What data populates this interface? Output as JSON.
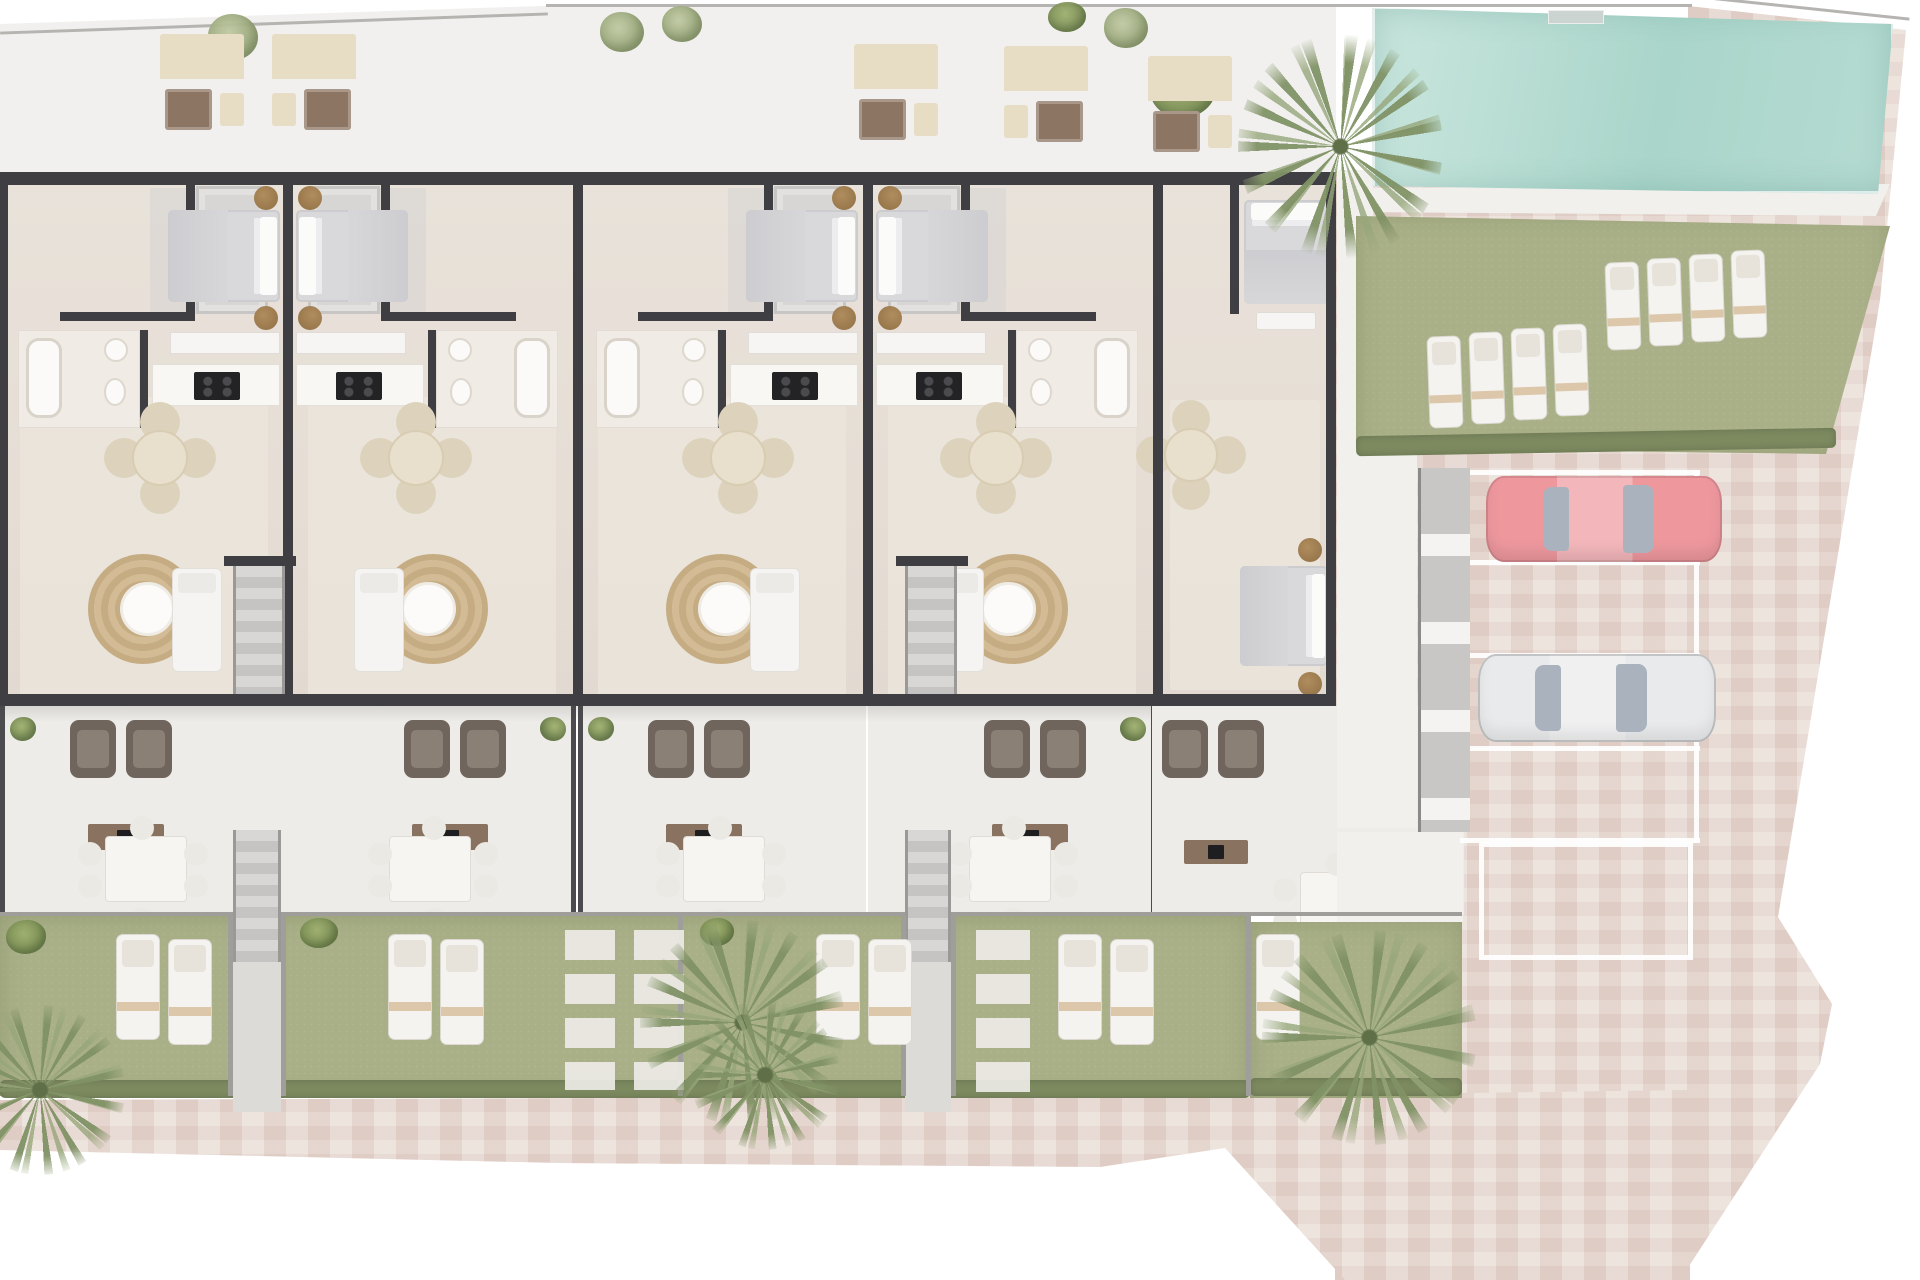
{
  "meta": {
    "description": "Top-down architectural floor plan rendering of a terraced residential block with roof terraces, private gardens, swimming pool and parking. No visible text in image."
  },
  "palette": {
    "bg": "#ffffff",
    "boundary": "#b5b4b1",
    "terraceTop": "#f1f0ee",
    "paving": "#e9dcd5",
    "wall": "#3f3e43",
    "glass": "#cdd3d6",
    "lawn": "#a9b088",
    "hedge": "#7d8a60",
    "carRed": "#ee989e",
    "carWhite": "#e9eaeb",
    "glassCar": "#aab2bd"
  },
  "unit_w": 288,
  "units": [
    {
      "name": "unit-1",
      "x": 0,
      "flip": false
    },
    {
      "name": "unit-2",
      "x": 288,
      "flip": true
    },
    {
      "name": "unit-3",
      "x": 578,
      "flip": false
    },
    {
      "name": "unit-4",
      "x": 868,
      "flip": true
    }
  ],
  "unit_parts": [
    {
      "cls": "patch",
      "name": "living-floor-patch",
      "x": 20,
      "y": 225,
      "w": 248,
      "h": 300
    },
    {
      "cls": "shade",
      "name": "hall-shade",
      "x": 150,
      "y": 16,
      "w": 118,
      "h": 126
    },
    {
      "cls": "balcony",
      "name": "lightwell-balcony",
      "x": 196,
      "y": 14,
      "w": 72,
      "h": 128
    },
    {
      "cls": "wall",
      "name": "bedroom-wall-v",
      "x": 186,
      "y": 12,
      "w": 9,
      "h": 132
    },
    {
      "cls": "wall",
      "name": "bedroom-wall-h",
      "x": 60,
      "y": 140,
      "w": 135,
      "h": 9
    },
    {
      "cls": "bed-h",
      "name": "double-bed",
      "x": 168,
      "y": 38,
      "w": 112,
      "h": 92
    },
    {
      "cls": "nightstand",
      "name": "nightstand",
      "x": 254,
      "y": 14,
      "w": 24,
      "h": 24
    },
    {
      "cls": "nightstand",
      "name": "nightstand",
      "x": 254,
      "y": 134,
      "w": 24,
      "h": 24
    },
    {
      "cls": "closet",
      "name": "wardrobe",
      "x": 170,
      "y": 160,
      "w": 110,
      "h": 22
    },
    {
      "cls": "bathfloor",
      "name": "bathroom",
      "x": 18,
      "y": 158,
      "w": 122,
      "h": 98
    },
    {
      "cls": "tub",
      "name": "bathtub",
      "x": 26,
      "y": 166,
      "w": 36,
      "h": 80
    },
    {
      "cls": "sink",
      "name": "washbasin",
      "x": 104,
      "y": 166,
      "w": 24,
      "h": 24
    },
    {
      "cls": "sink",
      "name": "toilet",
      "x": 104,
      "y": 206,
      "w": 22,
      "h": 28
    },
    {
      "cls": "wall",
      "name": "bath-wall-v",
      "x": 140,
      "y": 158,
      "w": 8,
      "h": 98
    },
    {
      "cls": "counter",
      "name": "kitchen-counter",
      "x": 152,
      "y": 192,
      "w": 128,
      "h": 42
    },
    {
      "cls": "cooktop",
      "name": "cooktop",
      "x": 194,
      "y": 200,
      "w": 46,
      "h": 28
    },
    {
      "cls": "dining",
      "name": "dining-table-set",
      "x": 132,
      "y": 258,
      "w": 56,
      "h": 56
    },
    {
      "cls": "rug",
      "name": "jute-rug-coffee-table",
      "x": 88,
      "y": 382,
      "w": 110,
      "h": 110
    },
    {
      "cls": "sofa",
      "name": "living-sofa",
      "x": 172,
      "y": 396,
      "w": 50,
      "h": 104
    },
    {
      "cls": "glass",
      "name": "facade-window",
      "x": 22,
      "y": 2,
      "w": 116,
      "h": 8
    },
    {
      "cls": "glass",
      "name": "facade-window",
      "x": 196,
      "y": 2,
      "w": 70,
      "h": 8
    },
    {
      "cls": "doorgap",
      "name": "garden-door",
      "x": 115,
      "y": 523,
      "w": 60,
      "h": 11
    },
    {
      "cls": "terrace",
      "name": "private-terrace",
      "x": 2,
      "y": 534,
      "w": 286,
      "h": 209
    },
    {
      "cls": "post",
      "name": "terrace-divider",
      "x": 0,
      "y": 534,
      "w": 5,
      "h": 209
    },
    {
      "cls": "armchair",
      "name": "terrace-armchair",
      "x": 70,
      "y": 548,
      "w": 46,
      "h": 58
    },
    {
      "cls": "armchair",
      "name": "terrace-armchair",
      "x": 126,
      "y": 548,
      "w": 46,
      "h": 58
    },
    {
      "cls": "sideboard",
      "name": "tv-sideboard",
      "x": 88,
      "y": 652,
      "w": 76,
      "h": 26
    },
    {
      "cls": "outtable",
      "name": "outdoor-dining-set",
      "x": 105,
      "y": 664,
      "w": 82,
      "h": 66
    },
    {
      "cls": "bush",
      "name": "terrace-plant",
      "x": 10,
      "y": 545,
      "w": 26,
      "h": 24
    }
  ],
  "elements": [
    {
      "cls": "paving",
      "name": "paved-area-right",
      "x": 1335,
      "y": 0,
      "w": 585,
      "h": 1280,
      "clip": "polygon(0px 170px,353px 170px,353px 6px,571px 30px,545px 300px,443px 917px,497px 1004px,485px 1064px,345px 1280px,0px 1280px)"
    },
    {
      "cls": "paving",
      "name": "paved-area-bottom",
      "x": 0,
      "y": 1090,
      "w": 1690,
      "h": 190,
      "clip": "polygon(0px 10px,1240px 6px,1690px 0px,1690px 190px,1345px 190px,1225px 58px,1100px 77px,560px 73px,0px 60px)"
    },
    {
      "cls": "band",
      "name": "roof-terrace-band",
      "x": 0,
      "y": 4,
      "w": 1336,
      "h": 170,
      "clip": "polygon(0px 20px,540px 2px,1336px 2px,1336px 170px,0px 170px)"
    },
    {
      "cls": "bline",
      "name": "plot-boundary-line",
      "x": 0,
      "y": 22,
      "w": 548,
      "h": 3,
      "r": -2
    },
    {
      "cls": "bline",
      "name": "plot-boundary-line",
      "x": 546,
      "y": 4,
      "w": 1146,
      "h": 3
    },
    {
      "cls": "bline",
      "name": "plot-boundary-line",
      "x": 1688,
      "y": 6,
      "w": 222,
      "h": 3,
      "r": 6
    },
    {
      "cls": "tree",
      "name": "terrace-tree",
      "x": 208,
      "y": 14,
      "w": 50,
      "h": 46
    },
    {
      "cls": "tree",
      "name": "terrace-tree",
      "x": 600,
      "y": 12,
      "w": 44,
      "h": 40
    },
    {
      "cls": "tree",
      "name": "terrace-tree",
      "x": 662,
      "y": 6,
      "w": 40,
      "h": 36
    },
    {
      "cls": "tree",
      "name": "terrace-tree",
      "x": 1104,
      "y": 8,
      "w": 44,
      "h": 40
    },
    {
      "cls": "bush",
      "name": "terrace-bush",
      "x": 1150,
      "y": 60,
      "w": 66,
      "h": 58
    },
    {
      "cls": "bush",
      "name": "terrace-bush",
      "x": 1048,
      "y": 2,
      "w": 38,
      "h": 30
    },
    {
      "cls": "sofaset",
      "name": "roof-lounge-set",
      "x": 160,
      "y": 34,
      "w": 84,
      "h": 98
    },
    {
      "cls": "sofaset",
      "name": "roof-lounge-set",
      "x": 272,
      "y": 34,
      "w": 84,
      "h": 98,
      "flip": true
    },
    {
      "cls": "sofaset",
      "name": "roof-lounge-set",
      "x": 854,
      "y": 44,
      "w": 84,
      "h": 98
    },
    {
      "cls": "sofaset",
      "name": "roof-lounge-set",
      "x": 1004,
      "y": 46,
      "w": 84,
      "h": 98,
      "flip": true
    },
    {
      "cls": "sofaset",
      "name": "roof-lounge-set",
      "x": 1148,
      "y": 56,
      "w": 84,
      "h": 98
    },
    {
      "cls": "floor",
      "name": "building-floor",
      "x": 0,
      "y": 172,
      "w": 1336,
      "h": 534
    },
    {
      "slot": "units"
    },
    {
      "cls": "patch",
      "name": "end-unit-floor",
      "x": 1170,
      "y": 400,
      "w": 150,
      "h": 290
    },
    {
      "cls": "bed-v",
      "name": "end-unit-bed",
      "x": 1244,
      "y": 200,
      "w": 84,
      "h": 104
    },
    {
      "cls": "bench",
      "name": "end-unit-bench",
      "x": 1256,
      "y": 312,
      "w": 60,
      "h": 18
    },
    {
      "cls": "wall",
      "name": "end-unit-wall",
      "x": 1230,
      "y": 184,
      "w": 9,
      "h": 130
    },
    {
      "cls": "dining",
      "name": "end-unit-dining-set",
      "x": 1164,
      "y": 428,
      "w": 54,
      "h": 54
    },
    {
      "cls": "bed-h",
      "name": "end-unit-bed-2",
      "x": 1240,
      "y": 566,
      "w": 88,
      "h": 100
    },
    {
      "cls": "nightstand",
      "name": "nightstand",
      "x": 1298,
      "y": 538,
      "w": 24,
      "h": 24
    },
    {
      "cls": "nightstand",
      "name": "nightstand",
      "x": 1298,
      "y": 672,
      "w": 24,
      "h": 24
    },
    {
      "cls": "wall",
      "name": "facade-wall-top",
      "x": 0,
      "y": 172,
      "w": 1336,
      "h": 13
    },
    {
      "cls": "wall",
      "name": "facade-wall-bottom",
      "x": 0,
      "y": 694,
      "w": 1336,
      "h": 12
    },
    {
      "cls": "wall",
      "name": "party-wall",
      "x": 0,
      "y": 172,
      "w": 8,
      "h": 534
    },
    {
      "cls": "wall",
      "name": "party-wall",
      "x": 283,
      "y": 172,
      "w": 10,
      "h": 534
    },
    {
      "cls": "wall",
      "name": "party-wall",
      "x": 573,
      "y": 172,
      "w": 10,
      "h": 534
    },
    {
      "cls": "wall",
      "name": "party-wall",
      "x": 863,
      "y": 172,
      "w": 10,
      "h": 534
    },
    {
      "cls": "wall",
      "name": "party-wall",
      "x": 1153,
      "y": 172,
      "w": 10,
      "h": 534
    },
    {
      "cls": "wall",
      "name": "gable-wall",
      "x": 1326,
      "y": 172,
      "w": 10,
      "h": 534
    },
    {
      "cls": "wall",
      "name": "stair-core-wall",
      "x": 224,
      "y": 556,
      "w": 72,
      "h": 10
    },
    {
      "cls": "stairs",
      "name": "stair-core",
      "x": 233,
      "y": 566,
      "w": 52,
      "h": 128
    },
    {
      "cls": "wall",
      "name": "stair-core-wall",
      "x": 896,
      "y": 556,
      "w": 72,
      "h": 10
    },
    {
      "cls": "stairs",
      "name": "stair-core",
      "x": 905,
      "y": 566,
      "w": 52,
      "h": 128
    },
    {
      "cls": "shadow",
      "name": "building-shadow",
      "x": 0,
      "y": 706,
      "w": 1336,
      "h": 16
    },
    {
      "cls": "terrace",
      "name": "end-terrace",
      "x": 1152,
      "y": 706,
      "w": 312,
      "h": 209
    },
    {
      "cls": "armchair",
      "name": "terrace-armchair",
      "x": 1162,
      "y": 720,
      "w": 46,
      "h": 58
    },
    {
      "cls": "armchair",
      "name": "terrace-armchair",
      "x": 1218,
      "y": 720,
      "w": 46,
      "h": 58
    },
    {
      "cls": "sideboard",
      "name": "tv-sideboard",
      "x": 1184,
      "y": 840,
      "w": 64,
      "h": 24
    },
    {
      "cls": "outtable",
      "name": "outdoor-dining-set",
      "x": 1300,
      "y": 872,
      "w": 82,
      "h": 64
    },
    {
      "cls": "deck",
      "name": "side-walkway",
      "x": 1337,
      "y": 452,
      "w": 80,
      "h": 376
    },
    {
      "cls": "deck",
      "name": "side-walkway",
      "x": 1337,
      "y": 170,
      "w": 36,
      "h": 282
    },
    {
      "cls": "deck",
      "name": "end-garden-path",
      "x": 1337,
      "y": 832,
      "w": 126,
      "h": 90
    },
    {
      "cls": "gfence",
      "name": "garden-front-fence",
      "x": 0,
      "y": 912,
      "w": 1462,
      "h": 4
    },
    {
      "cls": "lawn",
      "name": "garden-lawn-strip",
      "x": 0,
      "y": 916,
      "w": 1250,
      "h": 180
    },
    {
      "cls": "hedge",
      "name": "garden-hedge",
      "x": 0,
      "y": 1080,
      "w": 1250,
      "h": 18
    },
    {
      "cls": "lawn",
      "name": "end-garden-lawn",
      "x": 1250,
      "y": 922,
      "w": 212,
      "h": 176
    },
    {
      "cls": "hedge",
      "name": "end-garden-hedge",
      "x": 1250,
      "y": 1078,
      "w": 212,
      "h": 18
    },
    {
      "cls": "gfence",
      "name": "garden-divider",
      "x": 678,
      "y": 916,
      "w": 5,
      "h": 180
    },
    {
      "cls": "gfence",
      "name": "garden-divider",
      "x": 1246,
      "y": 916,
      "w": 5,
      "h": 180
    },
    {
      "cls": "stairs",
      "name": "garden-stairs",
      "x": 233,
      "y": 830,
      "w": 48,
      "h": 132
    },
    {
      "cls": "path",
      "name": "garden-path",
      "x": 233,
      "y": 962,
      "w": 48,
      "h": 150
    },
    {
      "cls": "stairs",
      "name": "garden-stairs",
      "x": 905,
      "y": 830,
      "w": 46,
      "h": 132
    },
    {
      "cls": "path",
      "name": "garden-path",
      "x": 905,
      "y": 962,
      "w": 46,
      "h": 150
    },
    {
      "cls": "gfence",
      "name": "garden-divider",
      "x": 228,
      "y": 916,
      "w": 5,
      "h": 180
    },
    {
      "cls": "gfence",
      "name": "garden-divider",
      "x": 281,
      "y": 916,
      "w": 5,
      "h": 180
    },
    {
      "cls": "gfence",
      "name": "garden-divider",
      "x": 901,
      "y": 916,
      "w": 5,
      "h": 180
    },
    {
      "cls": "gfence",
      "name": "garden-divider",
      "x": 951,
      "y": 916,
      "w": 5,
      "h": 180
    },
    {
      "cls": "lounger",
      "name": "garden-lounger",
      "x": 116,
      "y": 934,
      "w": 44,
      "h": 106
    },
    {
      "cls": "lounger",
      "name": "garden-lounger",
      "x": 168,
      "y": 939,
      "w": 44,
      "h": 106
    },
    {
      "cls": "lounger",
      "name": "garden-lounger",
      "x": 388,
      "y": 934,
      "w": 44,
      "h": 106
    },
    {
      "cls": "lounger",
      "name": "garden-lounger",
      "x": 440,
      "y": 939,
      "w": 44,
      "h": 106
    },
    {
      "cls": "lounger",
      "name": "garden-lounger",
      "x": 816,
      "y": 934,
      "w": 44,
      "h": 106
    },
    {
      "cls": "lounger",
      "name": "garden-lounger",
      "x": 868,
      "y": 939,
      "w": 44,
      "h": 106
    },
    {
      "cls": "lounger",
      "name": "garden-lounger",
      "x": 1058,
      "y": 934,
      "w": 44,
      "h": 106
    },
    {
      "cls": "lounger",
      "name": "garden-lounger",
      "x": 1110,
      "y": 939,
      "w": 44,
      "h": 106
    },
    {
      "cls": "lounger",
      "name": "garden-lounger",
      "x": 1256,
      "y": 934,
      "w": 44,
      "h": 106
    },
    {
      "cls": "stones",
      "name": "stepping-stones",
      "x": 565,
      "y": 930,
      "w": 50,
      "h": 160
    },
    {
      "cls": "stones",
      "name": "stepping-stones",
      "x": 634,
      "y": 930,
      "w": 50,
      "h": 160
    },
    {
      "cls": "stones",
      "name": "stepping-stones",
      "x": 976,
      "y": 930,
      "w": 54,
      "h": 170
    },
    {
      "cls": "bush",
      "name": "garden-bush",
      "x": 6,
      "y": 920,
      "w": 40,
      "h": 34
    },
    {
      "cls": "bush",
      "name": "garden-bush",
      "x": 300,
      "y": 918,
      "w": 38,
      "h": 30
    },
    {
      "cls": "bush",
      "name": "garden-bush",
      "x": 700,
      "y": 918,
      "w": 34,
      "h": 28
    },
    {
      "cls": "palm",
      "name": "garden-palm",
      "x": 640,
      "y": 920,
      "w": 205,
      "h": 205
    },
    {
      "cls": "palm",
      "name": "garden-palm",
      "x": 690,
      "y": 1000,
      "w": 150,
      "h": 150
    },
    {
      "cls": "palm",
      "name": "garden-palm",
      "x": 1262,
      "y": 930,
      "w": 215,
      "h": 215
    },
    {
      "cls": "palm",
      "name": "corner-palm",
      "x": -45,
      "y": 1005,
      "w": 170,
      "h": 170
    },
    {
      "cls": "deck",
      "name": "pool-deck",
      "x": 1356,
      "y": 184,
      "w": 534,
      "h": 32,
      "clip": "polygon(0px 4px,534px 0px,520px 32px,0px 28px)"
    },
    {
      "cls": "pool",
      "name": "swimming-pool",
      "x": 1372,
      "y": 6,
      "w": 522,
      "h": 188,
      "clip": "polygon(0px 2px,521px 18px,506px 188px,0px 180px)"
    },
    {
      "cls": "steps",
      "name": "pool-steps",
      "x": 1548,
      "y": 10,
      "w": 56,
      "h": 14
    },
    {
      "cls": "lawn",
      "name": "pool-lawn",
      "x": 1356,
      "y": 214,
      "w": 534,
      "h": 240,
      "clip": "polygon(0px 2px,534px 12px,470px 240px,0px 234px)"
    },
    {
      "cls": "hedge",
      "name": "pool-hedge",
      "x": 1356,
      "y": 432,
      "w": 480,
      "h": 20,
      "r": -1
    },
    {
      "cls": "lounger",
      "name": "pool-lounger",
      "x": 1428,
      "y": 336,
      "w": 34,
      "h": 92,
      "r": -2
    },
    {
      "cls": "lounger",
      "name": "pool-lounger",
      "x": 1470,
      "y": 332,
      "w": 34,
      "h": 92,
      "r": -2
    },
    {
      "cls": "lounger",
      "name": "pool-lounger",
      "x": 1512,
      "y": 328,
      "w": 34,
      "h": 92,
      "r": -2
    },
    {
      "cls": "lounger",
      "name": "pool-lounger",
      "x": 1554,
      "y": 324,
      "w": 34,
      "h": 92,
      "r": -2
    },
    {
      "cls": "lounger",
      "name": "pool-lounger",
      "x": 1606,
      "y": 262,
      "w": 34,
      "h": 88,
      "r": -2
    },
    {
      "cls": "lounger",
      "name": "pool-lounger",
      "x": 1648,
      "y": 258,
      "w": 34,
      "h": 88,
      "r": -2
    },
    {
      "cls": "lounger",
      "name": "pool-lounger",
      "x": 1690,
      "y": 254,
      "w": 34,
      "h": 88,
      "r": -2
    },
    {
      "cls": "lounger",
      "name": "pool-lounger",
      "x": 1732,
      "y": 250,
      "w": 34,
      "h": 88,
      "r": -2
    },
    {
      "cls": "palm",
      "name": "pool-palm",
      "x": 1238,
      "y": 34,
      "w": 205,
      "h": 225
    },
    {
      "cls": "pline",
      "name": "parking-line",
      "x": 1460,
      "y": 470,
      "w": 240,
      "h": 5
    },
    {
      "cls": "pline",
      "name": "parking-line",
      "x": 1460,
      "y": 560,
      "w": 240,
      "h": 5
    },
    {
      "cls": "pline",
      "name": "parking-line",
      "x": 1460,
      "y": 653,
      "w": 240,
      "h": 5
    },
    {
      "cls": "pline",
      "name": "parking-line",
      "x": 1460,
      "y": 746,
      "w": 240,
      "h": 5
    },
    {
      "cls": "pline",
      "name": "parking-line",
      "x": 1460,
      "y": 838,
      "w": 240,
      "h": 5
    },
    {
      "cls": "pline",
      "name": "parking-line-vertical",
      "x": 1694,
      "y": 470,
      "w": 5,
      "h": 373
    },
    {
      "cls": "pspace",
      "name": "empty-parking-space",
      "x": 1479,
      "y": 842,
      "w": 214,
      "h": 118
    },
    {
      "cls": "storage",
      "name": "storage-units",
      "x": 1418,
      "y": 468,
      "w": 52,
      "h": 364
    },
    {
      "cls": "car car-red",
      "name": "red-car",
      "x": 1486,
      "y": 476,
      "w": 236,
      "h": 86
    },
    {
      "cls": "car car-white",
      "name": "white-car",
      "x": 1478,
      "y": 654,
      "w": 238,
      "h": 88
    }
  ]
}
